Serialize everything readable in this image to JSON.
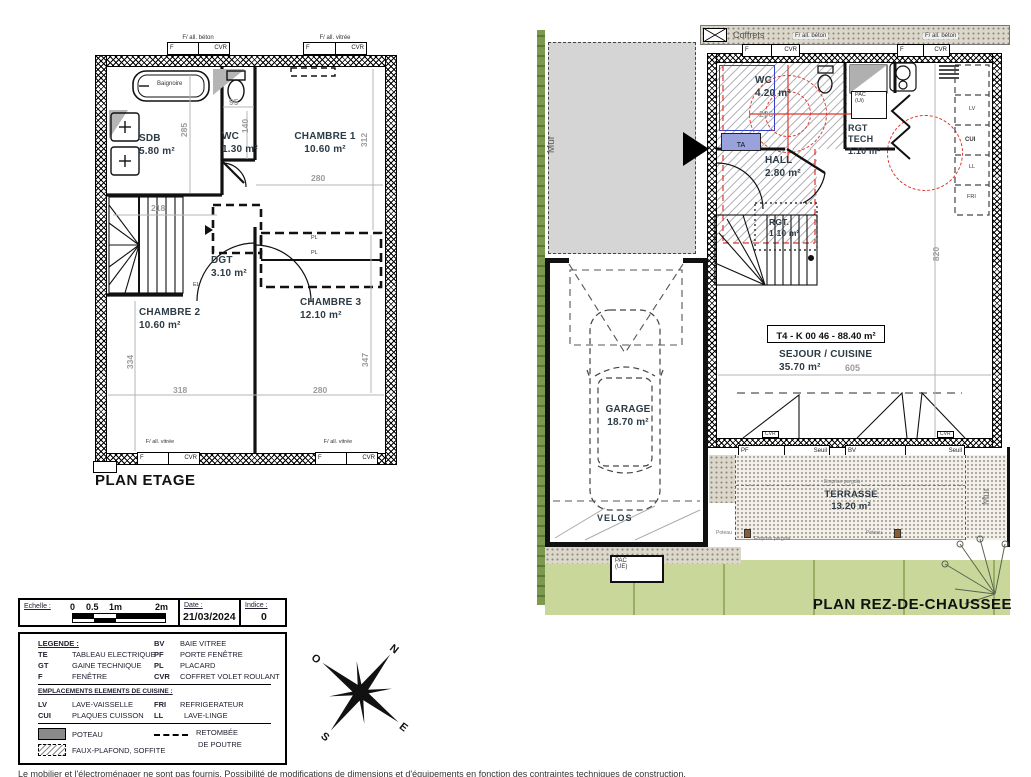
{
  "etage": {
    "title": "PLAN ETAGE",
    "win_top_left": "F/ all. béton",
    "win_top_right": "F/ all. vitrée",
    "win_bottom": "F/ all. vitrée",
    "tag_f": "F",
    "tag_cvr": "CVR",
    "baignoire": "Baignoire",
    "el": "EL",
    "pl": "PL",
    "rooms": {
      "sdb": {
        "name": "SDB",
        "area": "5.80 m²"
      },
      "wc": {
        "name": "WC",
        "area": "1.30 m²"
      },
      "ch1": {
        "name": "CHAMBRE 1",
        "area": "10.60 m²"
      },
      "dgt": {
        "name": "DGT",
        "area": "3.10 m²"
      },
      "ch2": {
        "name": "CHAMBRE 2",
        "area": "10.60 m²"
      },
      "ch3": {
        "name": "CHAMBRE 3",
        "area": "12.10 m²"
      }
    },
    "dims": {
      "sdb_h": "285",
      "sdb_w": "218",
      "wc_w": "95",
      "wc_h": "140",
      "ch1_h": "312",
      "ch1_w": "280",
      "ch2_h": "334",
      "ch2_w": "318",
      "ch3_h": "347",
      "ch3_w": "280"
    }
  },
  "rdc": {
    "title": "PLAN REZ-DE-CHAUSSEE",
    "coffrets": "Coffrets",
    "beton": "F/ all. béton",
    "mur": "Mur",
    "ta": "TA",
    "unit": "T4 - K 00 46 - 88.40 m²",
    "rooms": {
      "wc": {
        "name": "WC",
        "area": "4.20 m²"
      },
      "hall": {
        "name": "HALL",
        "area": "2.80 m²"
      },
      "rgt_tech": {
        "l1": "RGT",
        "l2": "TECH",
        "area": "1.10 m²"
      },
      "rgt": {
        "name": "RGT.",
        "area": "1,10 m²"
      },
      "sejour": {
        "name": "SEJOUR / CUISINE",
        "area": "35.70 m²"
      },
      "garage": {
        "name": "GARAGE",
        "area": "18.70 m²"
      },
      "velos": "VELOS",
      "terrasse": {
        "name": "TERRASSE",
        "area": "13.20 m²"
      }
    },
    "pac_ui": {
      "l1": "PAC",
      "l2": "(Ui)"
    },
    "pac_ue": {
      "l1": "PAC",
      "l2": "(UE)"
    },
    "kitchen": {
      "lv": "LV",
      "cui": "CUI",
      "ll": "LL",
      "fri": "FRI"
    },
    "dims": {
      "wc_w": "296",
      "h": "820",
      "sejour_w": "605"
    },
    "tags": {
      "pf": "PF",
      "seuil": "Seuil",
      "bv": "BV",
      "cvr": "CVR",
      "f": "F"
    },
    "poteau": "Poteau",
    "pergola": "Emprise pergola"
  },
  "legend": {
    "echelle_label": "Echelle :",
    "scale_ticks": [
      "0",
      "0.5",
      "1m",
      "2m"
    ],
    "date_label": "Date :",
    "date_value": "21/03/2024",
    "indice_label": "Indice :",
    "indice_value": "0",
    "title": "LEGENDE :",
    "col1": [
      {
        "abbr": "TE",
        "desc": "TABLEAU ELECTRIQUE"
      },
      {
        "abbr": "GT",
        "desc": "GAINE TECHNIQUE"
      },
      {
        "abbr": "F",
        "desc": "FENÊTRE"
      }
    ],
    "col2": [
      {
        "abbr": "BV",
        "desc": "BAIE VITREE"
      },
      {
        "abbr": "PF",
        "desc": "PORTE FENÊTRE"
      },
      {
        "abbr": "PL",
        "desc": "PLACARD"
      },
      {
        "abbr": "CVR",
        "desc": "COFFRET VOLET ROULANT"
      }
    ],
    "cuisine_title": "EMPLACEMENTS ELEMENTS DE CUISINE :",
    "cuisine_col1": [
      {
        "abbr": "LV",
        "desc": "LAVE-VAISSELLE"
      },
      {
        "abbr": "CUI",
        "desc": "PLAQUES CUISSON"
      }
    ],
    "cuisine_col2": [
      {
        "abbr": "FRI",
        "desc": "REFRIGERATEUR"
      },
      {
        "abbr": "LL",
        "desc": "LAVE-LINGE"
      }
    ],
    "poteau": "POTEAU",
    "faux_plafond": "FAUX-PLAFOND, SOFFITE",
    "retombee_l1": "RETOMBÉE",
    "retombee_l2": "DE POUTRE"
  },
  "compass": {
    "n": "N",
    "e": "E",
    "s": "S",
    "o": "O"
  },
  "colors": {
    "red": "#e0352b",
    "blue": "#3340c8",
    "grass": "#c9d79a",
    "mur_gray": "#d5d5d5"
  },
  "footer": "Le mobilier et l'électroménager ne sont pas fournis. Possibilité de modifications de dimensions et d'équipements en fonction des contraintes techniques de construction."
}
